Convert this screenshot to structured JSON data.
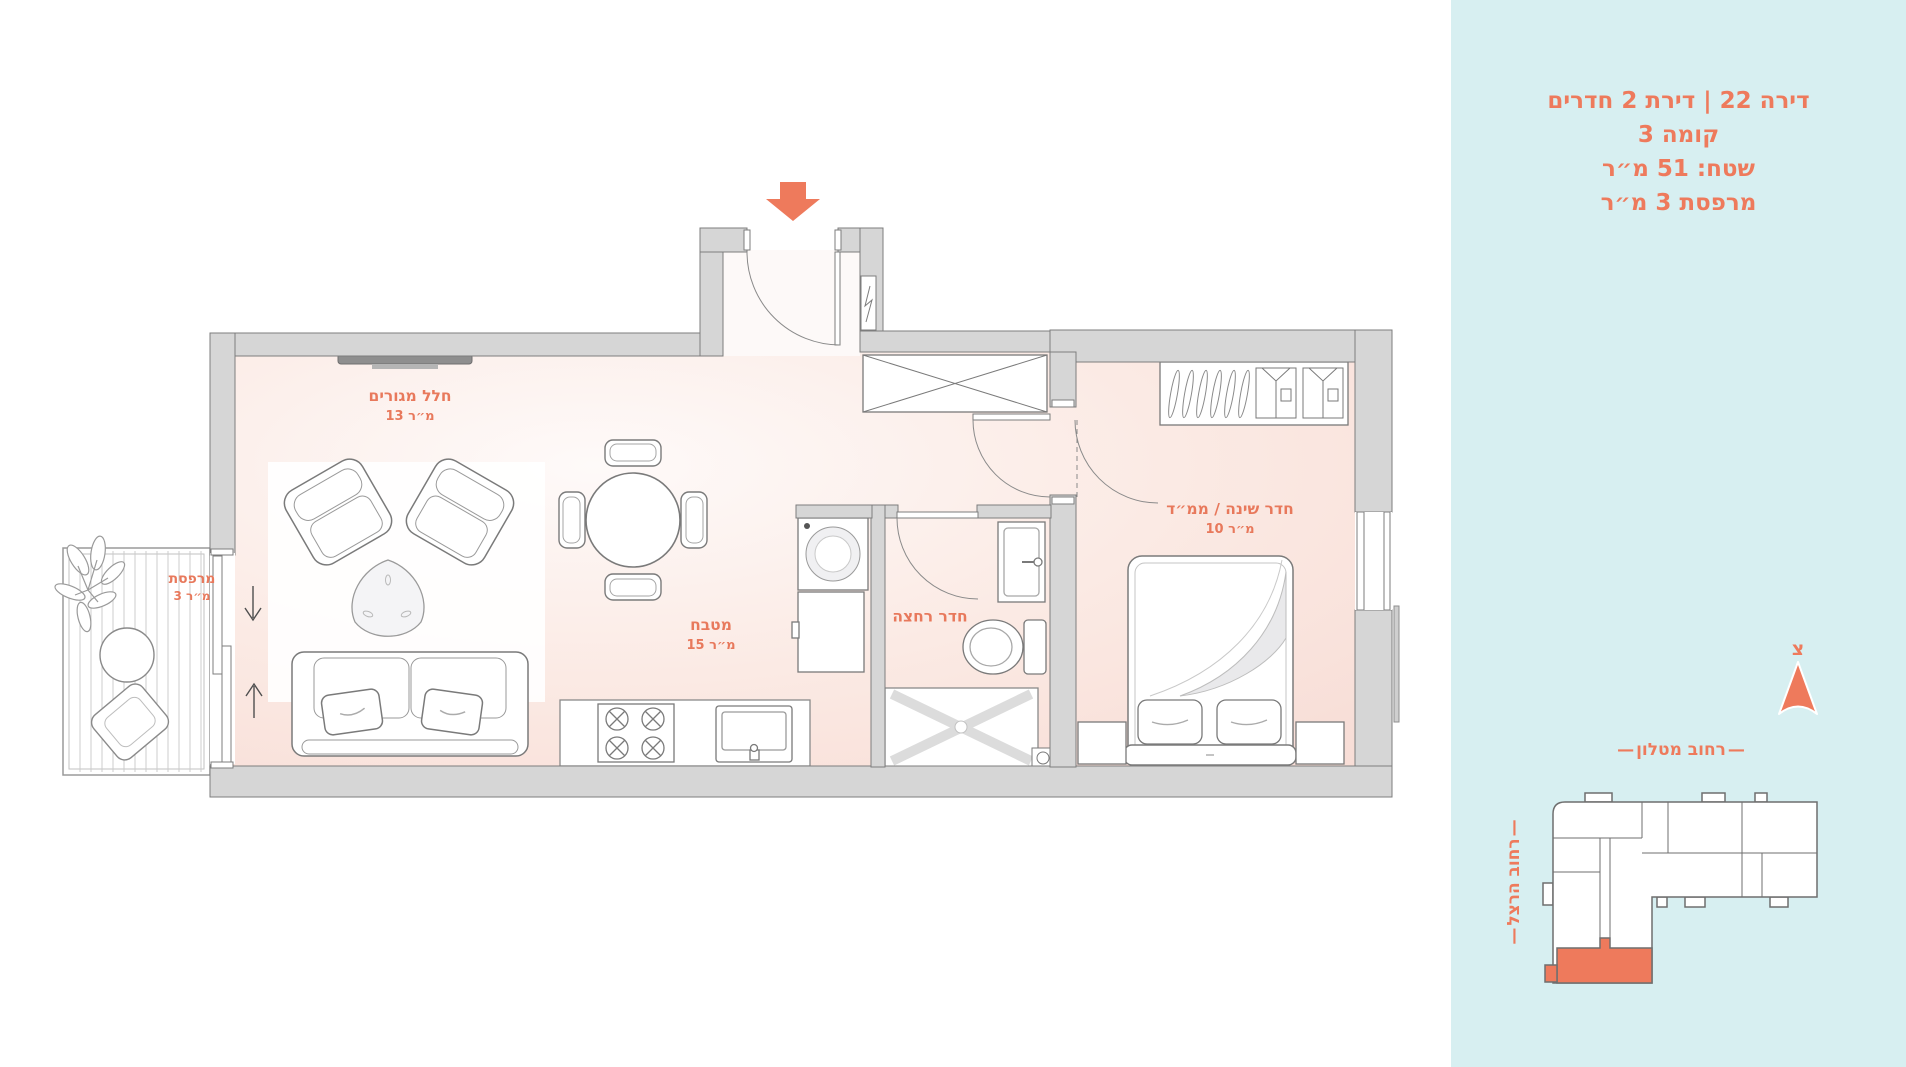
{
  "panel": {
    "bg_color": "#d7eff1",
    "accent_color": "#ee7a5c",
    "info_lines": [
      "דירה 22 | דירת 2 חדרים",
      "קומה 3",
      "שטח: 51 מ״ר",
      "מרפסת 3 מ״ר"
    ],
    "compass": {
      "letter": "צ"
    },
    "streets": {
      "top": "רחוב מטלון",
      "side": "רחוב הרצל",
      "dash": "—"
    }
  },
  "floorplan": {
    "rooms": [
      {
        "name": "חלל מגורים",
        "area": "13 מ״ר"
      },
      {
        "name": "מטבח",
        "area": "15 מ״ר"
      },
      {
        "name": "חדר רחצה",
        "area": ""
      },
      {
        "name": "חדר שינה / ממ״ד",
        "area": "10 מ״ר"
      },
      {
        "name": "מרפסת",
        "area": "3 מ״ר"
      }
    ],
    "colors": {
      "wall": "#d6d6d6",
      "wall_stroke": "#7d7d7d",
      "floor_pink": "#f8ded7",
      "entrance_arrow": "#ee7a5c"
    }
  }
}
